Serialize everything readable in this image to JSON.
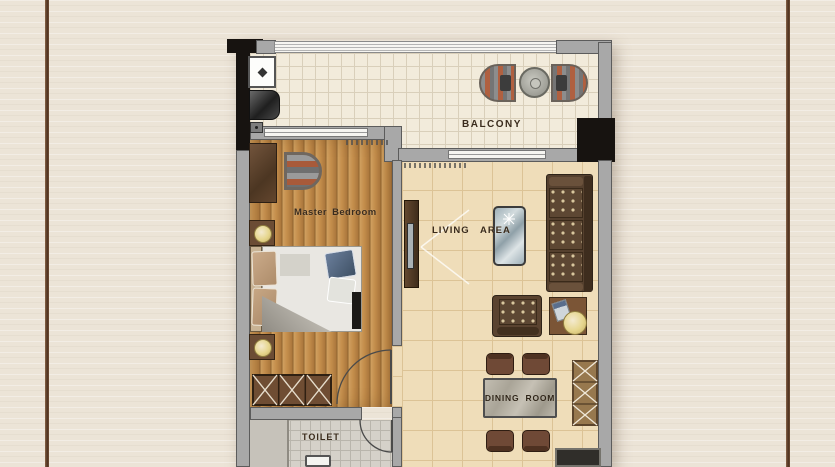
{
  "rooms": {
    "balcony": {
      "label": "BALCONY"
    },
    "master_bedroom": {
      "label": "Master Bedroom"
    },
    "living_area": {
      "label": "LIVING AREA"
    },
    "dining_room": {
      "label": "DINING ROOM"
    },
    "toilet": {
      "label": "TOILET"
    }
  },
  "furniture_icons": [
    "laundry-sink",
    "washing-machine",
    "balcony-armchair",
    "balcony-round-table",
    "desk",
    "tub-chair",
    "nightstand",
    "table-lamp",
    "double-bed",
    "bed-pillow",
    "wardrobe-x-cabinet",
    "tv-cabinet",
    "coffee-table",
    "sofa",
    "armchair",
    "side-table",
    "dining-table",
    "dining-chair",
    "storage-x-cabinet",
    "kitchen-counter",
    "toilet-basin",
    "door-swing"
  ],
  "colors": {
    "page_background": "#ece4d7",
    "frame_line": "#4e3220",
    "wall_gray": "#a8a8a8",
    "wall_black": "#171310",
    "wood_floor": "#c48e4c",
    "living_floor": "#efddb9",
    "balcony_floor": "#f2ebdb",
    "toilet_floor": "#d5d1c9",
    "furniture_brown": "#5d4733",
    "lamp_accent": "#e6d68d",
    "label_text": "#3a2b1c"
  }
}
